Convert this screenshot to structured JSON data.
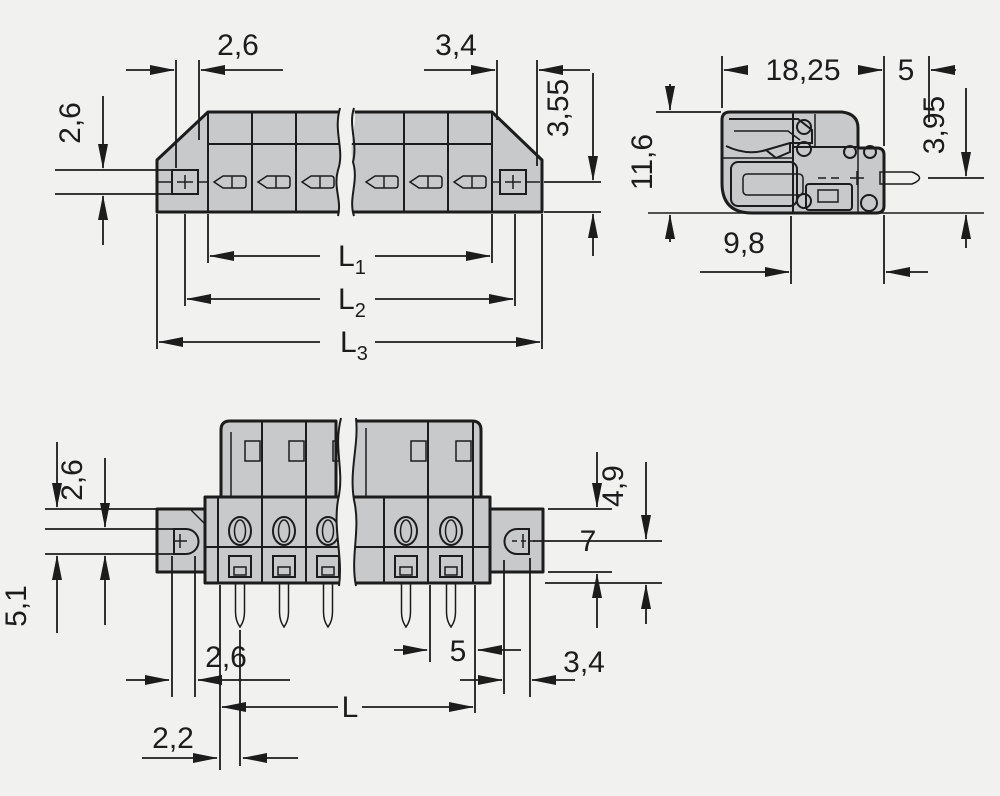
{
  "title": "Connector dimensional drawing",
  "colors": {
    "background": "#f1f1ef",
    "line": "#1c1c1c",
    "body_fill": "#c7c9ca",
    "detail_fill": "#e9e9e9",
    "white_fill": "#fbfbfb",
    "pin_fill": "#f0b183",
    "contact_fill": "#edc59e"
  },
  "views": {
    "front": {
      "name": "front-view",
      "dims": {
        "d26_top": "2,6",
        "d34_top": "3,4",
        "d26_left": "2,6",
        "d355_right": "3,55",
        "L1_base": "L",
        "L1_sub": "1",
        "L2_base": "L",
        "L2_sub": "2",
        "L3_base": "L",
        "L3_sub": "3"
      }
    },
    "side": {
      "name": "side-view",
      "dims": {
        "d1825": "18,25",
        "d5": "5",
        "d395": "3,95",
        "d116": "11,6",
        "d98": "9,8"
      }
    },
    "bottom": {
      "name": "bottom-view",
      "dims": {
        "d26_vertical": "2,6",
        "d51": "5,1",
        "d49": "4,9",
        "d7": "7",
        "d26_pitch": "2,6",
        "d5_pitch": "5",
        "d34": "3,4",
        "L_base": "L",
        "d22": "2,2"
      }
    }
  }
}
